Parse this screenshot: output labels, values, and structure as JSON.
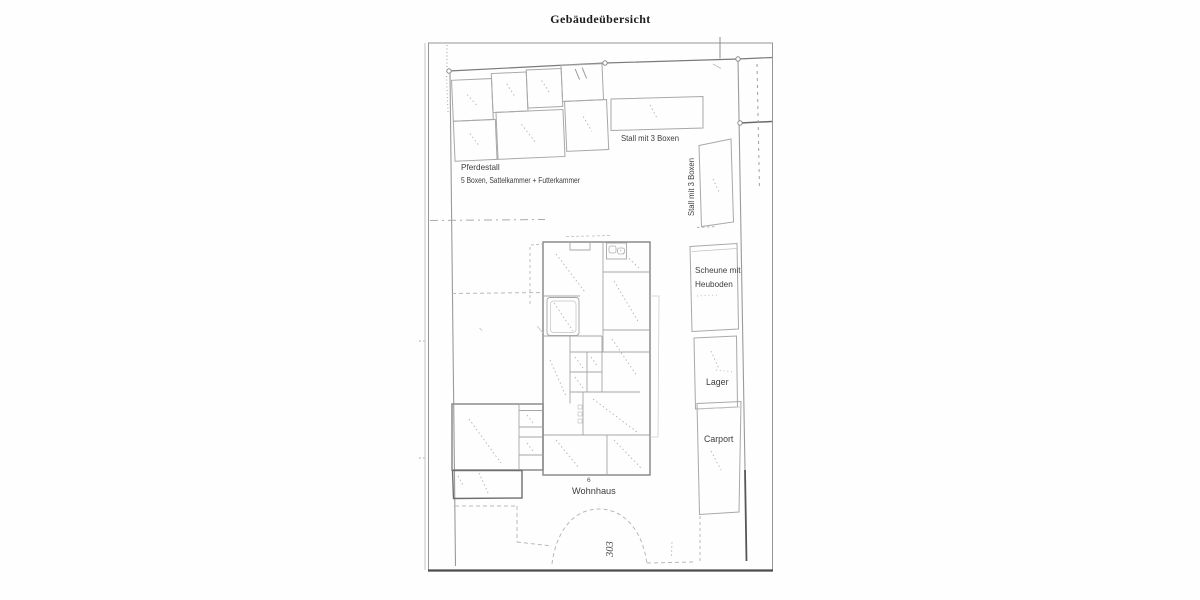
{
  "document": {
    "title": "Gebäudeübersicht"
  },
  "plan": {
    "labels": {
      "pferdestall_line1": "Pferdestall",
      "pferdestall_line2": "5 Boxen, Sattelkammer + Futterkammer",
      "stall_top": "Stall mit 3 Boxen",
      "stall_right": "Stall mit 3 Boxen",
      "scheune_line1": "Scheune mit",
      "scheune_line2": "Heuboden",
      "lager": "Lager",
      "carport": "Carport",
      "wohnhaus": "Wohnhaus",
      "wohnhaus_number": "6",
      "parcel_number": "303"
    },
    "colors": {
      "building_outline": "#a8a8a8",
      "strong_outline": "#6e6e6e",
      "boundary_line": "#7a7a7a",
      "label_text": "#3d3d3d",
      "pencil_marks": "#b3b1bb"
    }
  }
}
